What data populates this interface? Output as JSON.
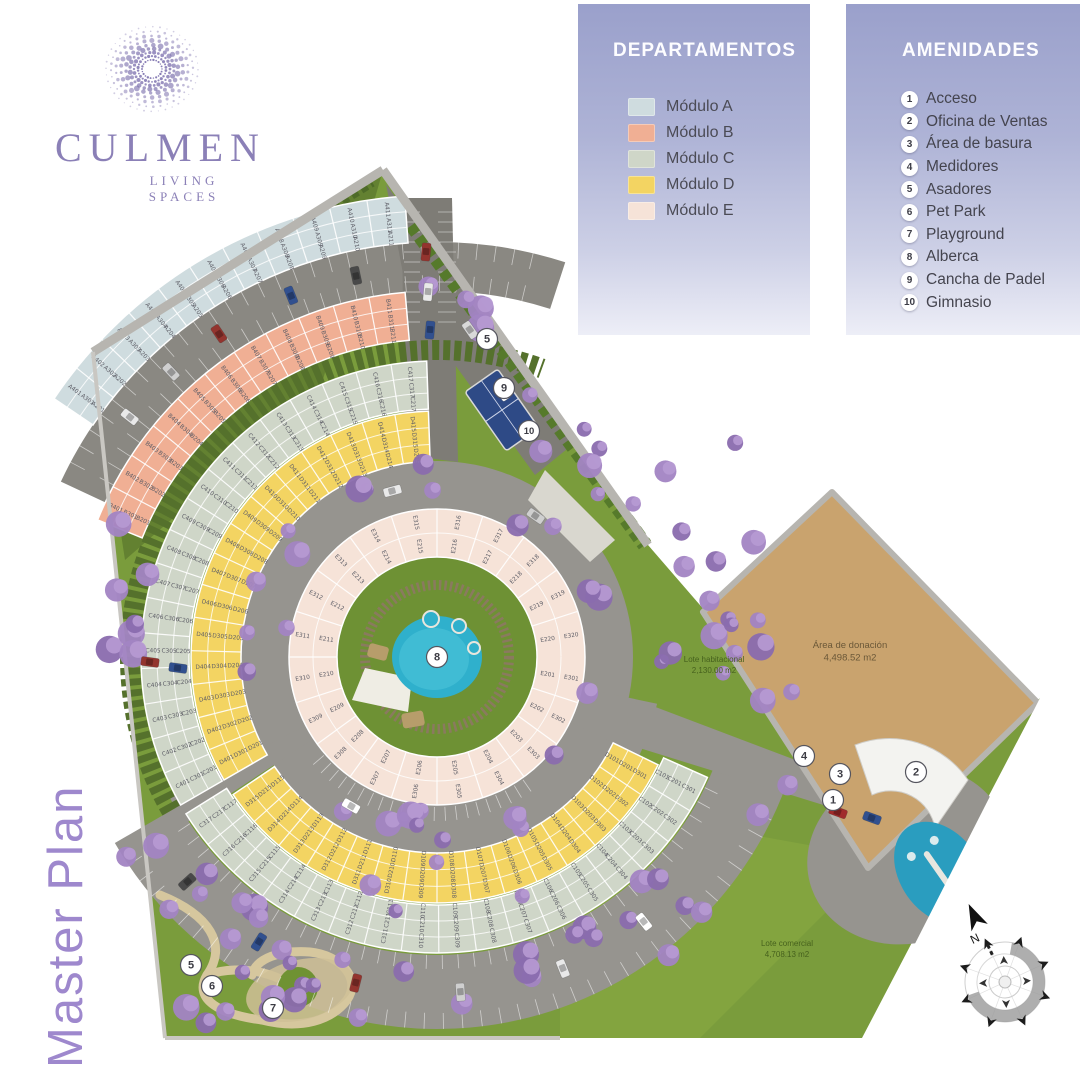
{
  "logo": {
    "brand": "CULMEN",
    "tagline": "LIVING SPACES"
  },
  "watermark": "Master Plan",
  "panels": {
    "departamentos": {
      "title": "DEPARTAMENTOS",
      "modules": [
        {
          "id": "A",
          "label": "Módulo A",
          "color": "#cfdcdf"
        },
        {
          "id": "B",
          "label": "Módulo B",
          "color": "#f0af94"
        },
        {
          "id": "C",
          "label": "Módulo C",
          "color": "#cfd6c8"
        },
        {
          "id": "D",
          "label": "Módulo D",
          "color": "#f3d462"
        },
        {
          "id": "E",
          "label": "Módulo E",
          "color": "#f6e3d8"
        }
      ]
    },
    "amenidades": {
      "title": "AMENIDADES",
      "items": [
        {
          "number": "1",
          "label": "Acceso"
        },
        {
          "number": "2",
          "label": "Oficina de Ventas"
        },
        {
          "number": "3",
          "label": "Área de basura"
        },
        {
          "number": "4",
          "label": "Medidores"
        },
        {
          "number": "5",
          "label": "Asadores"
        },
        {
          "number": "6",
          "label": "Pet Park"
        },
        {
          "number": "7",
          "label": "Playground"
        },
        {
          "number": "8",
          "label": "Alberca"
        },
        {
          "number": "9",
          "label": "Cancha de Padel"
        },
        {
          "number": "10",
          "label": "Gimnasio"
        }
      ]
    }
  },
  "site_plan": {
    "center": {
      "x": 437,
      "y": 657
    },
    "colors": {
      "grass": "#7a9c3c",
      "grass_dark": "#5f7d2f",
      "grass_bright": "#84a53f",
      "road": "#96948f",
      "road_dark": "#7e7c76",
      "road_mid": "#8a8882",
      "hedge": "#55712c",
      "wall": "#b7b5b0",
      "wall_light": "#c9c7c2",
      "pool": "#2fb0cc",
      "pool_light": "#49c3d8",
      "deck": "#efede4",
      "donation": "#c9a36e",
      "tree_a": "#a284c3",
      "tree_b": "#b79ad3",
      "tree_c": "#8a6cae",
      "court": "#2e4a86",
      "path": "#d6c79e",
      "label": "#5d5d66"
    },
    "rings": [
      {
        "name": "modulo-a-arc",
        "module": "A",
        "r0": 415,
        "r1": 462,
        "a0": 214,
        "a1": 266,
        "units": 11,
        "rows": [
          {
            "prefix": "A4",
            "r": 450
          },
          {
            "prefix": "A3",
            "r": 434
          },
          {
            "prefix": "A2",
            "r": 421
          }
        ]
      },
      {
        "name": "modulo-b-arc",
        "module": "B",
        "r0": 318,
        "r1": 366,
        "a0": 202,
        "a1": 265,
        "units": 11,
        "rows": [
          {
            "prefix": "B4",
            "r": 354
          },
          {
            "prefix": "B3",
            "r": 338
          },
          {
            "prefix": "B2",
            "r": 324
          }
        ]
      },
      {
        "name": "modulo-c-upper-arc",
        "module": "C",
        "r0": 248,
        "r1": 296,
        "a0": 150,
        "a1": 268,
        "units": 17,
        "rows": [
          {
            "prefix": "C4",
            "r": 284
          },
          {
            "prefix": "C3",
            "r": 268
          },
          {
            "prefix": "C2",
            "r": 254
          }
        ]
      },
      {
        "name": "modulo-d-upper-arc",
        "module": "D",
        "r0": 196,
        "r1": 246,
        "a0": 150,
        "a1": 268,
        "units": 15,
        "rows": [
          {
            "prefix": "D4",
            "r": 234
          },
          {
            "prefix": "D3",
            "r": 218
          },
          {
            "prefix": "D2",
            "r": 202
          }
        ]
      },
      {
        "name": "modulo-c-lower-arc",
        "module": "C",
        "r0": 248,
        "r1": 296,
        "a0": 24,
        "a1": 148,
        "units": 17,
        "rows": [
          {
            "prefix": "C3",
            "r": 284
          },
          {
            "prefix": "C2",
            "r": 268
          },
          {
            "prefix": "C1",
            "r": 254
          }
        ]
      },
      {
        "name": "modulo-d-lower-arc",
        "module": "D",
        "r0": 196,
        "r1": 246,
        "a0": 26,
        "a1": 146,
        "units": 15,
        "rows": [
          {
            "prefix": "D3",
            "r": 234
          },
          {
            "prefix": "D2",
            "r": 218
          },
          {
            "prefix": "D1",
            "r": 202
          }
        ]
      },
      {
        "name": "modulo-e-ring",
        "module": "E",
        "r0": 100,
        "r1": 148,
        "a0": 0,
        "a1": 360,
        "units": 20,
        "rows": [
          {
            "prefix": "E3",
            "r": 136
          },
          {
            "prefix": "E2",
            "r": 112
          }
        ]
      }
    ],
    "markers": [
      {
        "n": "1",
        "x": 833,
        "y": 800
      },
      {
        "n": "2",
        "x": 916,
        "y": 772
      },
      {
        "n": "3",
        "x": 840,
        "y": 774
      },
      {
        "n": "4",
        "x": 804,
        "y": 756
      },
      {
        "n": "5",
        "x": 487,
        "y": 339
      },
      {
        "n": "5",
        "x": 191,
        "y": 965
      },
      {
        "n": "6",
        "x": 212,
        "y": 986
      },
      {
        "n": "7",
        "x": 273,
        "y": 1008
      },
      {
        "n": "8",
        "x": 437,
        "y": 657
      },
      {
        "n": "9",
        "x": 504,
        "y": 388
      },
      {
        "n": "10",
        "x": 529,
        "y": 431
      }
    ],
    "labels": [
      {
        "name": "area-donacion-label",
        "lines": [
          "Área de donación",
          "4,498.52 m2"
        ],
        "x": 850,
        "y": 648,
        "color": "#6b5838",
        "size": 9.5
      },
      {
        "name": "lote-habitacional-label",
        "lines": [
          "Lote habitacional",
          "2,130.00 m2"
        ],
        "x": 714,
        "y": 662,
        "color": "#46611d",
        "size": 8
      },
      {
        "name": "lote-comercial-label",
        "lines": [
          "Lote comercial",
          "4,708.13 m2"
        ],
        "x": 787,
        "y": 946,
        "color": "#46611d",
        "size": 8
      }
    ],
    "compass": {
      "north_label": "N"
    }
  }
}
